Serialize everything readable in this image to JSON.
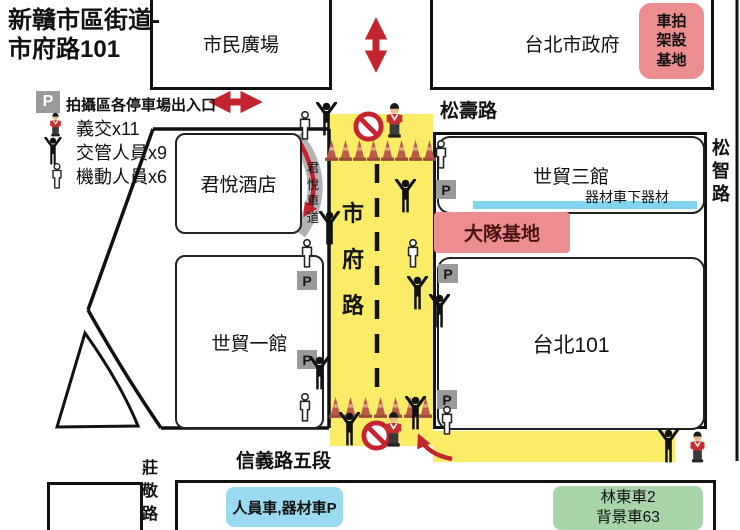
{
  "title": {
    "line1": "新贛市區街道-",
    "line2": "市府路101"
  },
  "legend": {
    "p_letter": "P",
    "p_label": "拍攝區各停車場出入口",
    "items": [
      {
        "icon": "volunteer-police-icon",
        "label": "義交x11"
      },
      {
        "icon": "traffic-controller-icon",
        "label": "交管人員x9"
      },
      {
        "icon": "mobile-staff-icon",
        "label": "機動人員x6"
      }
    ]
  },
  "streets": {
    "songshou": "松壽路",
    "songzhi": "松智路",
    "shifu": "市府路",
    "xinyi5": "信義路五段",
    "zhuangjing": "莊敬路",
    "hyatt_driveway": "君悅車道"
  },
  "buildings": {
    "civic_plaza": "市民廣場",
    "city_hall": "台北市政府",
    "grand_hyatt": "君悅酒店",
    "twtc3": "世貿三館",
    "twtc1": "世貿一館",
    "taipei101": "台北101"
  },
  "zones": {
    "car_rig_base": "車拍架設基地",
    "brigade_base": "大隊基地",
    "equipment_drop": "器材車下器材",
    "crew_parking": "人員車,器材車P",
    "background_cars_line1": "林東車2",
    "background_cars_line2": "背景車63"
  },
  "map_p_letter": "P",
  "icons": {
    "traffic-cone-icon": "road closure cone",
    "no-entry-icon": "no entry sign",
    "traffic-controller-icon": "black pictogram person, arms raised",
    "mobile-staff-icon": "white outline person",
    "volunteer-police-icon": "volunteer traffic officer figurine",
    "two-way-arrow-icon": "red double-headed arrow",
    "parking-sign": "gray P parking entrance marker"
  },
  "colors": {
    "road_yellow": "#fbec67",
    "arrow_red": "#c32430",
    "zone_pink": "#ec8e90",
    "bar_blue": "#82d4ee",
    "box_blue": "#9bdbf2",
    "box_green": "#a9d4a9",
    "p_gray": "#9a9a9a"
  }
}
